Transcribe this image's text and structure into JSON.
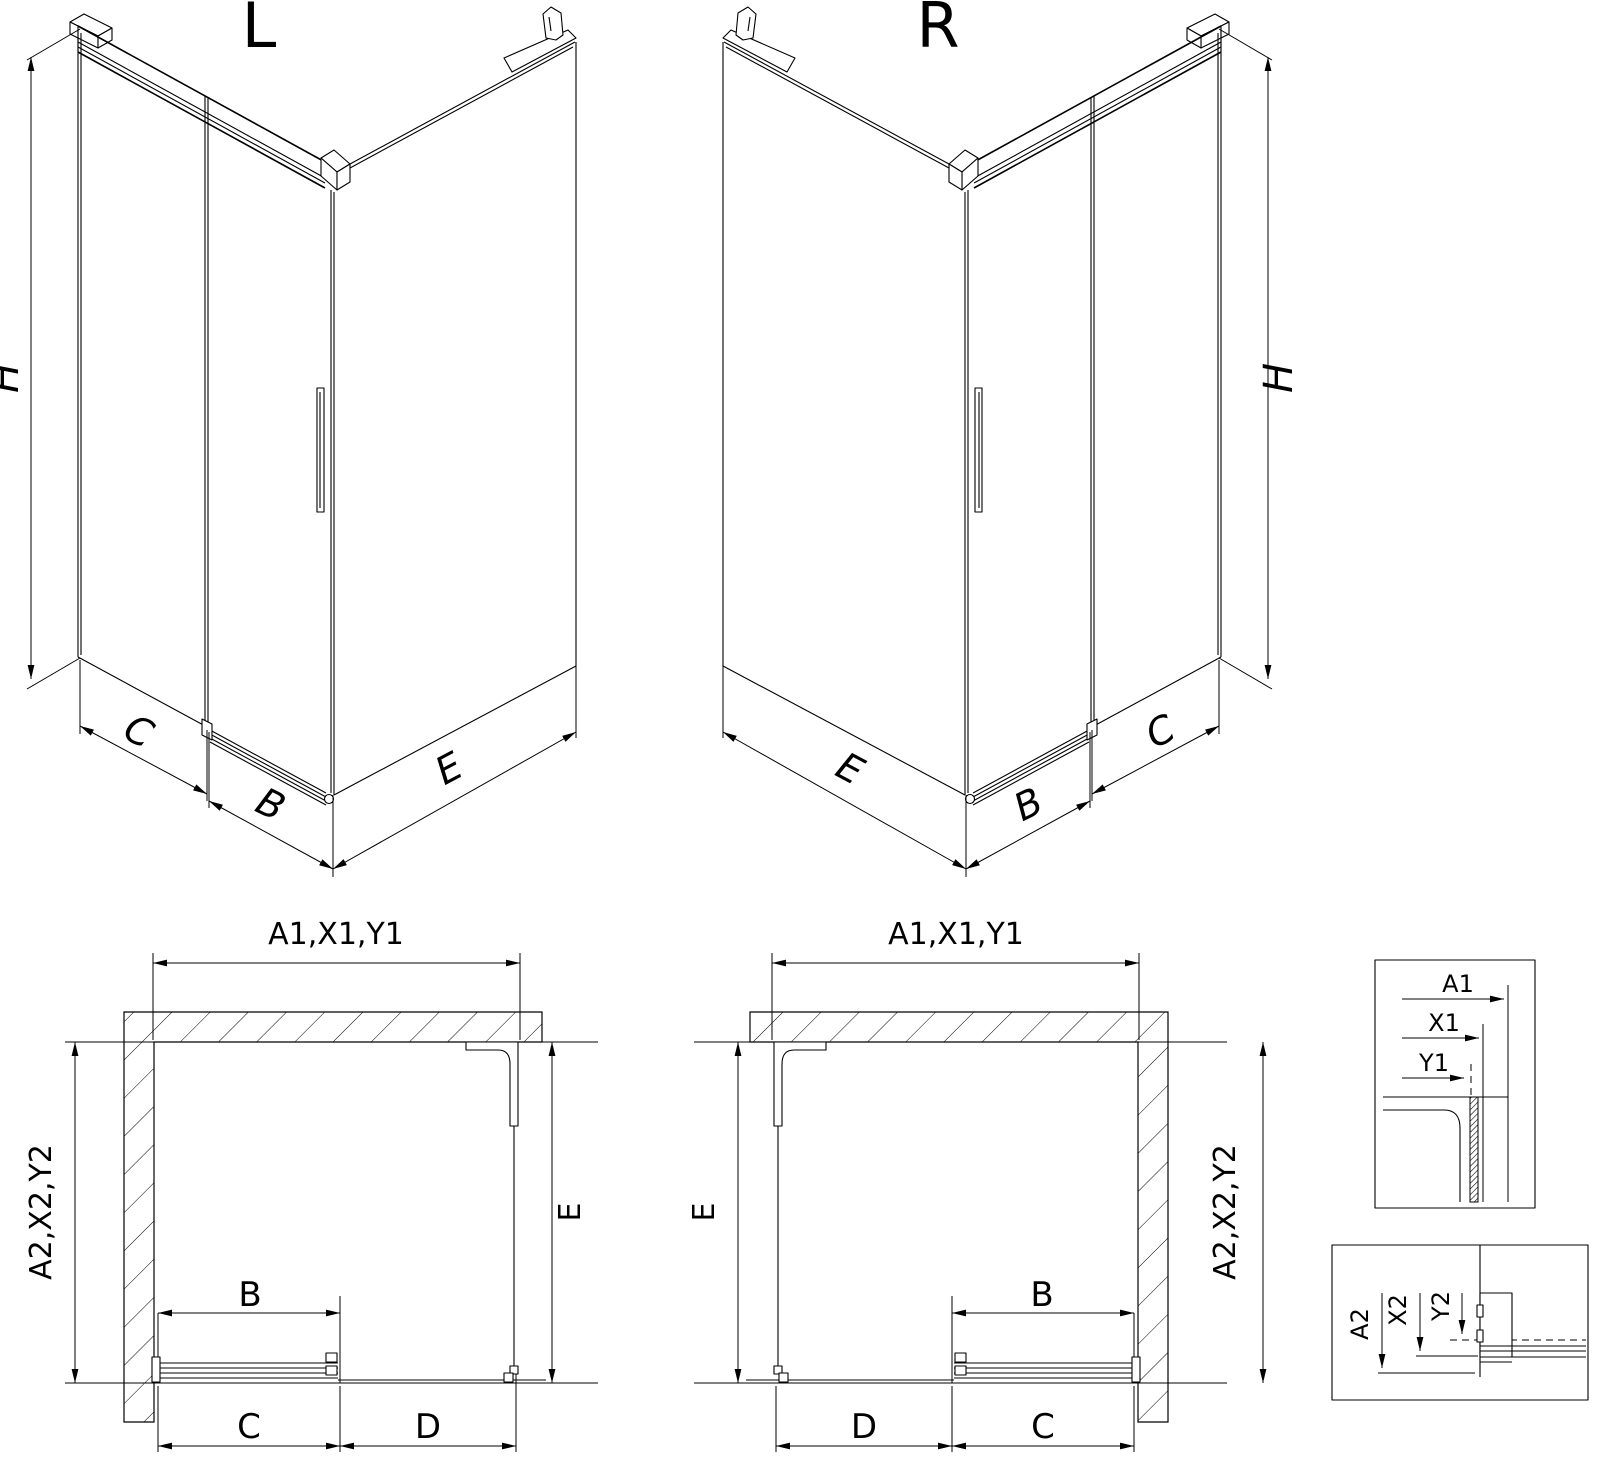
{
  "colors": {
    "line": "#000000",
    "background": "#ffffff"
  },
  "views": {
    "iso_left": {
      "title": "L",
      "height": "H",
      "wall_side": "C",
      "door": "B",
      "fixed_side": "E"
    },
    "iso_right": {
      "title": "R",
      "height": "H",
      "wall_side": "C",
      "door": "B",
      "fixed_side": "E"
    },
    "plan_left": {
      "width_total": "A1,X1,Y1",
      "depth_total": "A2,X2,Y2",
      "depth_inner": "E",
      "door": "B",
      "bottom_near": "C",
      "bottom_far": "D"
    },
    "plan_right": {
      "width_total": "A1,X1,Y1",
      "depth_total": "A2,X2,Y2",
      "depth_inner": "E",
      "door": "B",
      "bottom_near": "C",
      "bottom_far": "D"
    },
    "detail_top": {
      "a1": "A1",
      "x1": "X1",
      "y1": "Y1"
    },
    "detail_bottom": {
      "a2": "A2",
      "x2": "X2",
      "y2": "Y2"
    }
  }
}
